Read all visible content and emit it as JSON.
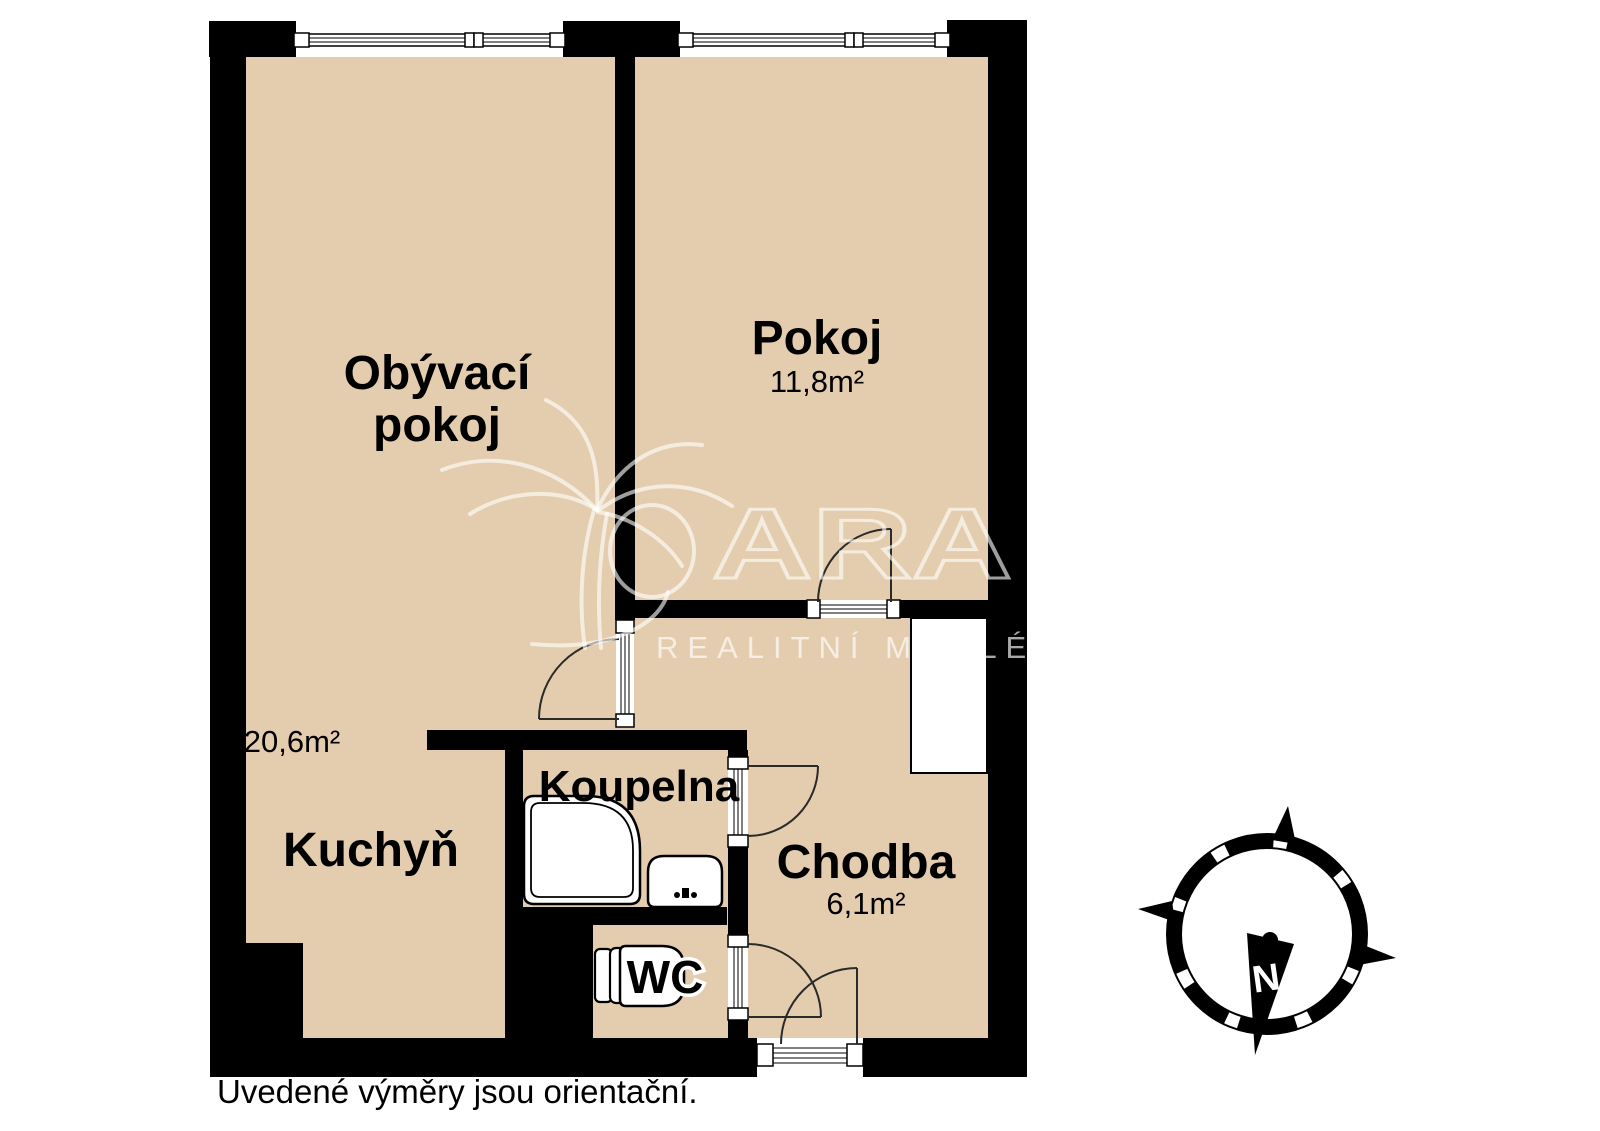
{
  "plan": {
    "rooms": {
      "living": {
        "name_line1": "Obývací",
        "name_line2": "pokoj",
        "area": "20,6m²"
      },
      "bedroom": {
        "name": "Pokoj",
        "area": "11,8m²"
      },
      "kitchen": {
        "name": "Kuchyň"
      },
      "bathroom": {
        "name": "Koupelna"
      },
      "hallway": {
        "name": "Chodba",
        "area": "6,1m²"
      },
      "wc": {
        "name": "WC"
      }
    },
    "caption": "Uvedené výměry jsou orientační."
  },
  "watermark": {
    "brand": "QARA",
    "brand_tail": "ARA",
    "tagline": "REALITNÍ MAKLÉŘI"
  },
  "compass": {
    "north_label": "N"
  },
  "colors": {
    "floor": "#e4ccaf",
    "wall": "#000000",
    "fixture": "#ffffff",
    "watermark": "rgba(255,255,255,0.62)"
  }
}
